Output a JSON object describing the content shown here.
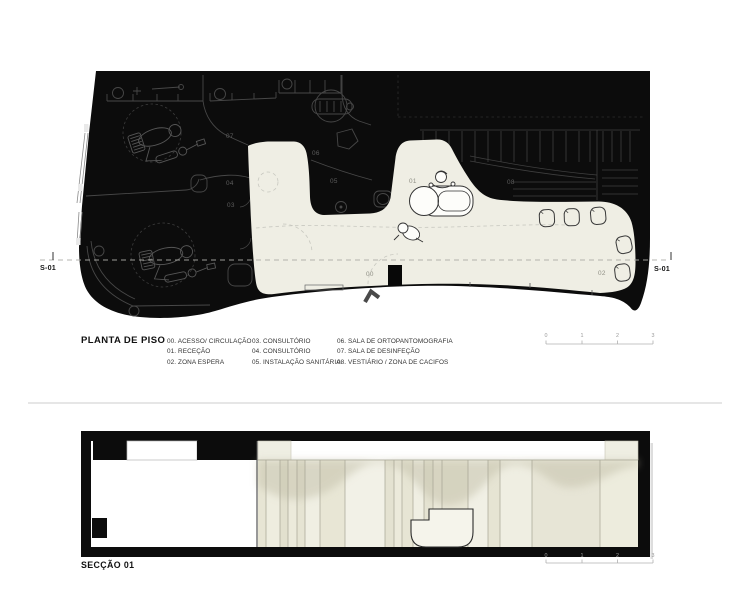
{
  "plan": {
    "title": "PLANTA DE PISO",
    "section_label": "S-01",
    "rooms": {
      "r00": "00",
      "r01": "01",
      "r02": "02",
      "r03": "03",
      "r04": "04",
      "r05": "05",
      "r06": "06",
      "r07": "07",
      "r08": "08"
    },
    "legend": {
      "col1": [
        "00. ACESSO/ CIRCULAÇÃO",
        "01. RECEÇÃO",
        "02. ZONA ESPERA"
      ],
      "col2": [
        "03. CONSULTÓRIO",
        "04. CONSULTÓRIO",
        "05. INSTALAÇÃO SANITÁRIA"
      ],
      "col3": [
        "06. SALA DE ORTOPANTOMOGRAFIA",
        "07. SALA DE DESINFEÇÃO",
        "08. VESTIÁRIO / ZONA DE CACIFOS"
      ]
    },
    "scale_labels": [
      "0",
      "1",
      "2",
      "3"
    ]
  },
  "section": {
    "title": "SECÇÃO 01",
    "scale_labels": [
      "0",
      "1",
      "2",
      "3"
    ]
  },
  "colors": {
    "poche_black": "#0c0c0c",
    "circulation_cream": "#efeee4",
    "panel_cream": "#e9e7d7",
    "line_gray_on_black": "#4a4a4a",
    "dashed_floor": "#c8c8c0",
    "scalebar_gray": "#a8a8a8"
  }
}
